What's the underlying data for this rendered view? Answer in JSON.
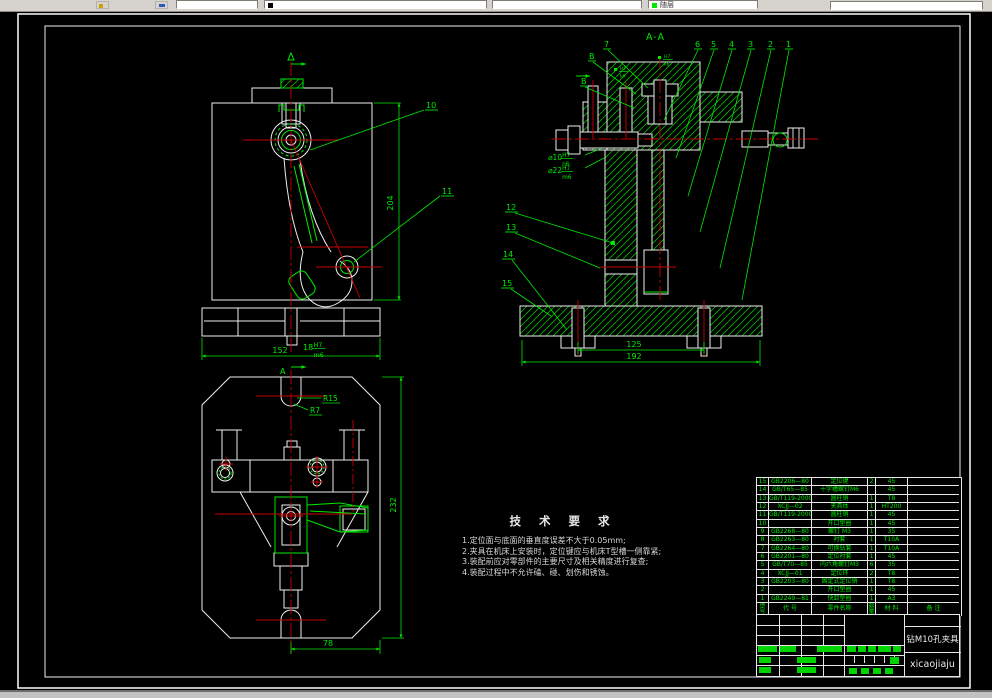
{
  "toolbar": {
    "color_value": "随层"
  },
  "drawing": {
    "section_label": "A-A",
    "callouts": [
      {
        "label": "1",
        "x": 786,
        "y": 47,
        "leader": [
          789,
          50,
          742,
          300
        ]
      },
      {
        "label": "2",
        "x": 768,
        "y": 47,
        "leader": [
          771,
          50,
          720,
          268
        ]
      },
      {
        "label": "3",
        "x": 748,
        "y": 47,
        "leader": [
          751,
          50,
          700,
          232
        ]
      },
      {
        "label": "4",
        "x": 729,
        "y": 47,
        "leader": [
          732,
          50,
          688,
          196
        ]
      },
      {
        "label": "5",
        "x": 711,
        "y": 47,
        "leader": [
          714,
          50,
          676,
          158
        ]
      },
      {
        "label": "6",
        "x": 695,
        "y": 47,
        "leader": [
          698,
          50,
          664,
          120
        ]
      },
      {
        "label": "7",
        "x": 604,
        "y": 47,
        "leader": [
          608,
          50,
          648,
          88
        ]
      },
      {
        "label": "B",
        "x": 589,
        "y": 59,
        "leader": [
          593,
          62,
          636,
          94
        ]
      },
      {
        "label": "B",
        "x": 581,
        "y": 84,
        "leader": [
          585,
          87,
          634,
          108
        ]
      },
      {
        "label": "12",
        "x": 506,
        "y": 210,
        "leader": [
          515,
          213,
          613,
          243
        ],
        "dot": true
      },
      {
        "label": "13",
        "x": 506,
        "y": 230,
        "leader": [
          515,
          233,
          600,
          268
        ]
      },
      {
        "label": "14",
        "x": 503,
        "y": 257,
        "leader": [
          512,
          260,
          567,
          330
        ]
      },
      {
        "label": "15",
        "x": 502,
        "y": 286,
        "leader": [
          511,
          289,
          551,
          316
        ]
      },
      {
        "label": "10",
        "x": 426,
        "y": 108,
        "leader": [
          310,
          150,
          424,
          110
        ]
      },
      {
        "label": "11",
        "x": 442,
        "y": 194,
        "leader": [
          354,
          262,
          440,
          196
        ]
      },
      {
        "label": "A",
        "x": 280,
        "y": 374,
        "ul": false
      }
    ],
    "dims": [
      {
        "label": "204",
        "x": 393,
        "y": 203,
        "rot": -90
      },
      {
        "label": "152",
        "x": 280,
        "y": 353
      },
      {
        "label": "232",
        "x": 396,
        "y": 505,
        "rot": -90
      },
      {
        "label": "78",
        "x": 328,
        "y": 646
      },
      {
        "label": "125",
        "x": 634,
        "y": 347
      },
      {
        "label": "192",
        "x": 634,
        "y": 359
      }
    ],
    "radius_labels": [
      {
        "label": "R15",
        "x": 323,
        "y": 401,
        "leader": [
          297,
          398,
          321,
          398
        ]
      },
      {
        "label": "R7",
        "x": 310,
        "y": 413,
        "leader": [
          294,
          404,
          308,
          410
        ]
      }
    ],
    "fits": [
      {
        "main": "18",
        "upper": "H7",
        "lower": "m6",
        "x": 303,
        "y": 347,
        "size": 7
      },
      {
        "main": "⌀10",
        "upper": "H7",
        "lower": "n6",
        "x": 548,
        "y": 157,
        "size": 6.5,
        "leader": [
          585,
          155,
          600,
          149
        ]
      },
      {
        "main": "⌀22",
        "upper": "H7",
        "lower": "m6",
        "x": 548,
        "y": 170,
        "size": 6.5,
        "leader": [
          585,
          168,
          604,
          158
        ]
      },
      {
        "main": "",
        "upper": "H7",
        "lower": "k6",
        "x": 620,
        "y": 70,
        "size": 5
      },
      {
        "main": "",
        "upper": "H7",
        "lower": "k6",
        "x": 664,
        "y": 58,
        "size": 5
      }
    ]
  },
  "tech_requirements": {
    "title": "技 术 要 求",
    "items": [
      "1.定位面与底面的垂直度误差不大于0.05mm;",
      "2.夹具在机床上安装时，定位键应与机床T型槽一侧靠紧;",
      "3.装配前应对零部件的主要尺寸及相关精度进行复查;",
      "4.装配过程中不允许磕、碰、划伤和锈蚀。"
    ]
  },
  "parts_table": {
    "headers": [
      "序号",
      "代  号",
      "零件名称",
      "数量",
      "材  料",
      "备  注"
    ],
    "rows": [
      [
        "15",
        "GB2206—80",
        "定位键",
        "2",
        "45",
        ""
      ],
      [
        "14",
        "GB/T65—85",
        "十字槽螺钉M6",
        "",
        "45",
        ""
      ],
      [
        "13",
        "GB/T119-2000",
        "圆柱销",
        "1",
        "T8",
        ""
      ],
      [
        "12",
        "XCJJ—02",
        "夹具体",
        "1",
        "HT200",
        ""
      ],
      [
        "11",
        "GB/T119-2000",
        "圆柱销",
        "1",
        "45",
        ""
      ],
      [
        "10",
        "",
        "开口垫圈",
        "1",
        "45",
        ""
      ],
      [
        "9",
        "GB2268—80",
        "螺钉 M3",
        "1",
        "35",
        ""
      ],
      [
        "8",
        "GB2263—80",
        "衬套",
        "1",
        "T10A",
        ""
      ],
      [
        "7",
        "GB2264—80",
        "可换钻套",
        "1",
        "T10A",
        ""
      ],
      [
        "6",
        "GB2201—80",
        "定位衬套",
        "1",
        "45",
        ""
      ],
      [
        "5",
        "GB/T70—85",
        "内六角螺钉M3",
        "6",
        "35",
        ""
      ],
      [
        "4",
        "XCJJ—01",
        "定位环",
        "2",
        "T8",
        ""
      ],
      [
        "3",
        "GB2203—80",
        "固定式定位销",
        "1",
        "T8",
        ""
      ],
      [
        "2",
        "",
        "开口垫圈",
        "1",
        "45",
        ""
      ],
      [
        "1",
        "GB2249—81",
        "快卸垫圈",
        "1",
        "A3",
        ""
      ]
    ]
  },
  "title_block": {
    "drawing_title": "钻M10孔夹具",
    "file_label": "xicaojiaju"
  },
  "colors": {
    "line_green": "#00e800",
    "hatch_green": "#00b400",
    "centerline_red": "#c80000",
    "line_white": "#eeeeee",
    "background": "#000000",
    "toolbar_bg": "#d6d3ce"
  }
}
